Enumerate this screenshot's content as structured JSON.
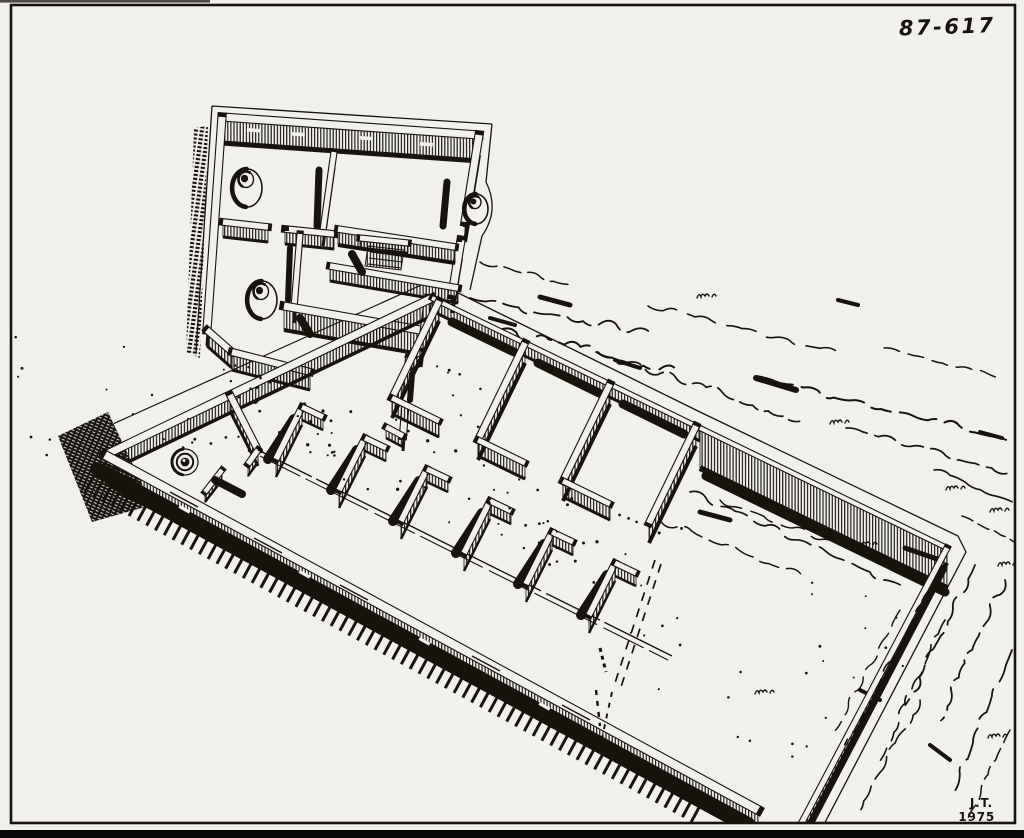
{
  "figure": {
    "catalog_number": "87-617",
    "signature_initials": "J.T.",
    "signature_year": "1975"
  },
  "illustration": {
    "name": "axonometric-ruins-drawing",
    "style": "black ink line drawing"
  },
  "colors": {
    "paper": "#f2f0eb",
    "ink": "#17140e",
    "photo_edge": "#0a0908"
  }
}
